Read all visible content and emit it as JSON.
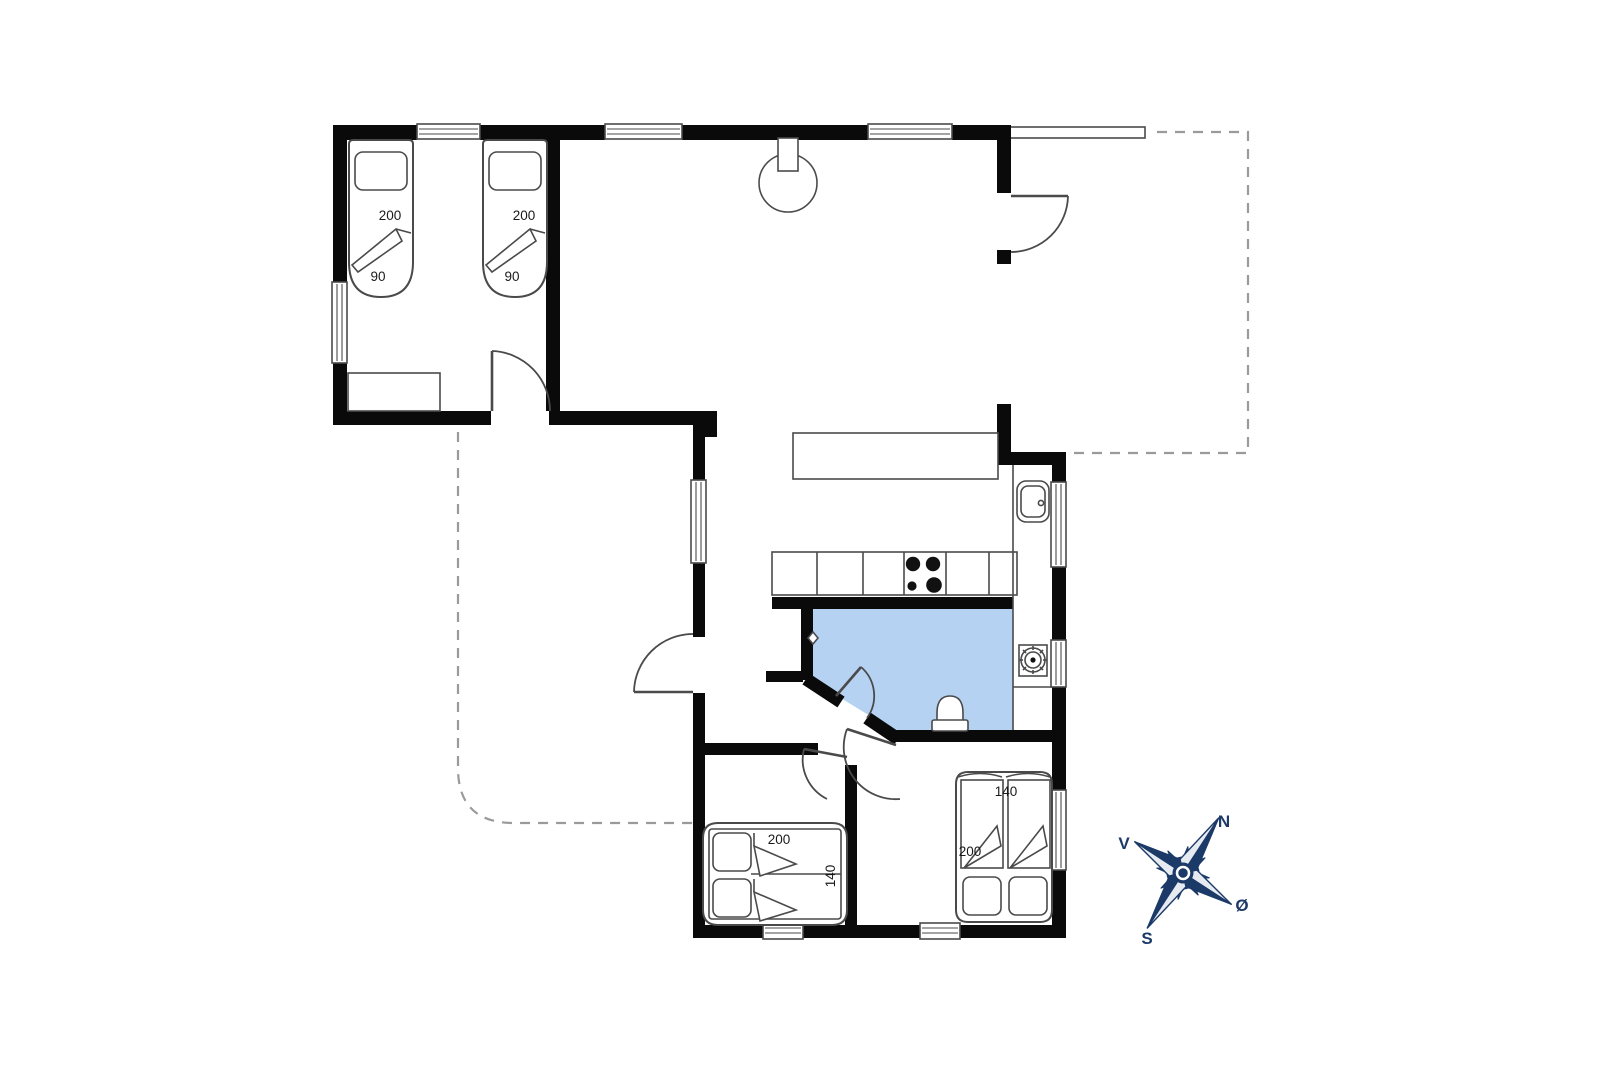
{
  "document": {
    "type": "floor-plan",
    "style": "architectural-plan"
  },
  "colors": {
    "wall": "#0a0a0a",
    "line": "#4a4a4a",
    "light_line": "#8c8c8c",
    "bathroom_fill": "#b5d2f3",
    "dash": "#9a9a9a",
    "compass": "#1c3a68",
    "compass_light": "#e6eaf1",
    "text": "#1a1a1a",
    "background": "#ffffff"
  },
  "rooms": {
    "bedroom_top_left": {
      "beds": [
        {
          "length": "200",
          "width": "90"
        },
        {
          "length": "200",
          "width": "90"
        }
      ]
    },
    "bedroom_bottom_left": {
      "bed": {
        "length": "200",
        "width": "140"
      }
    },
    "bedroom_bottom_right": {
      "bed": {
        "width": "140",
        "length": "200"
      }
    }
  },
  "compass": {
    "north": "N",
    "east": "Ø",
    "south": "S",
    "west": "V"
  }
}
